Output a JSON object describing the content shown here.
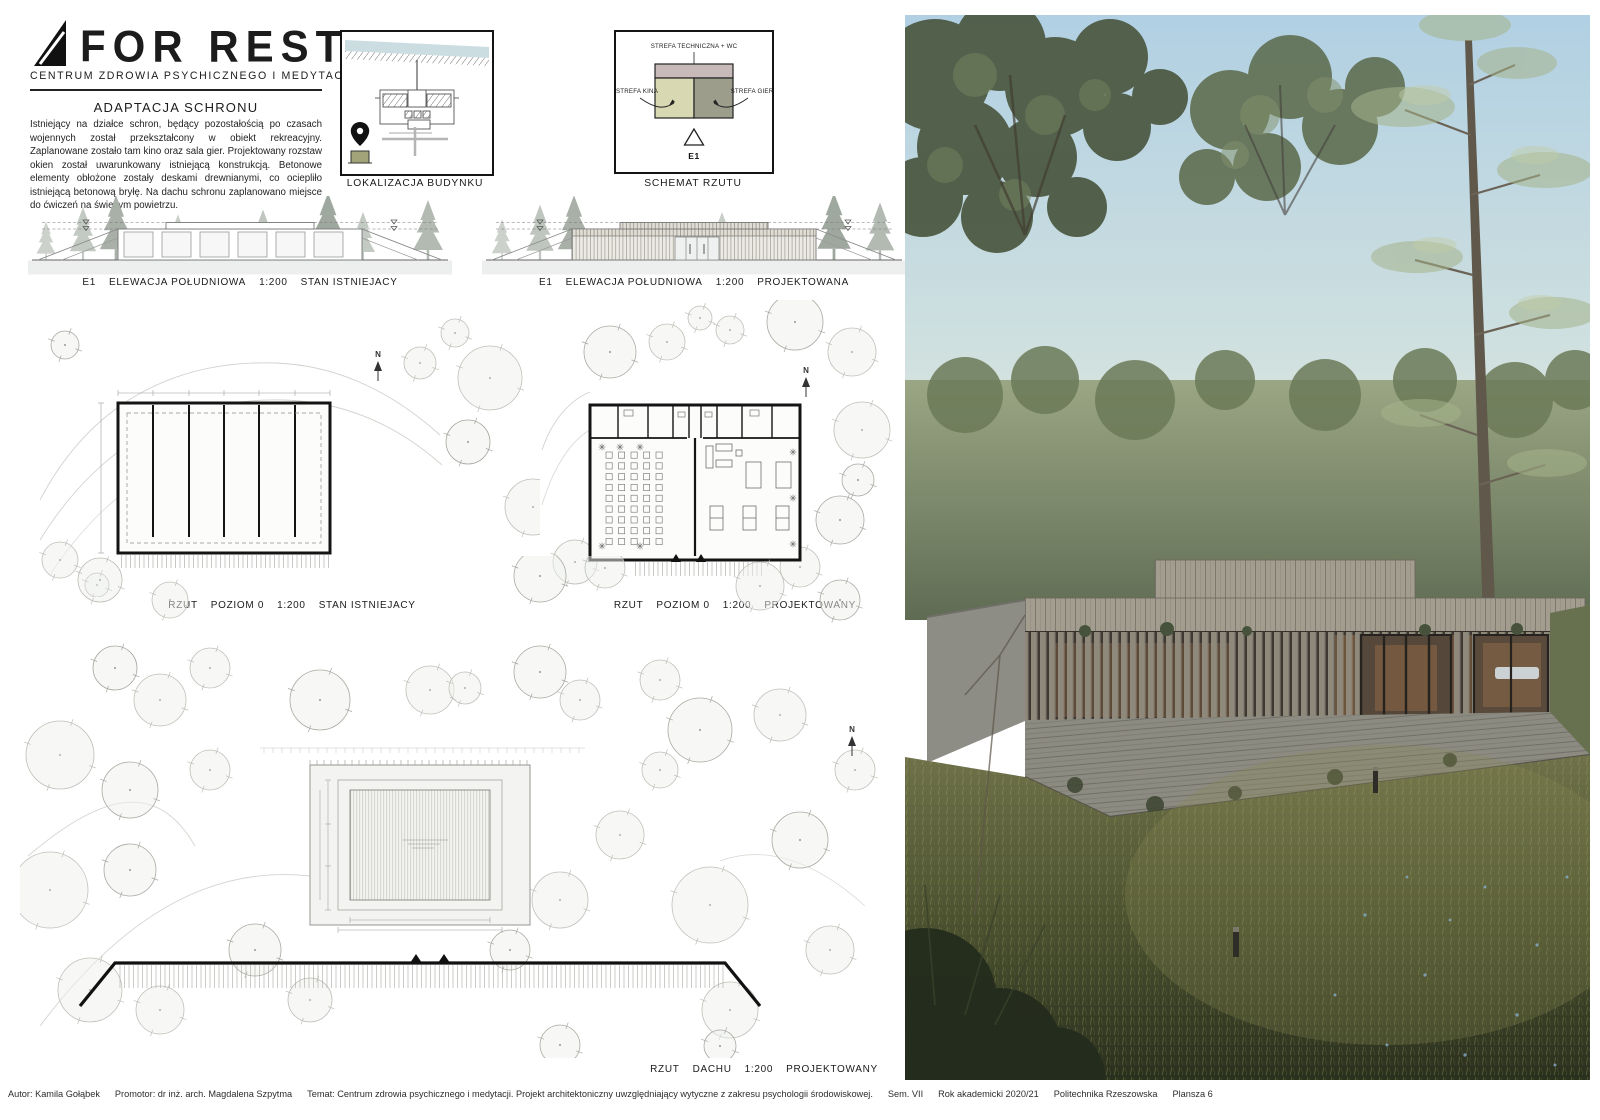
{
  "branding": {
    "logo_text": "FOR REST",
    "tagline": "CENTRUM ZDROWIA PSYCHICZNEGO I MEDYTACJI"
  },
  "intro": {
    "title": "ADAPTACJA SCHRONU",
    "body": "Istniejący na działce schron, będący pozostałością po czasach wojennych został przekształcony w obiekt rekreacyjny. Zaplanowane zostało tam kino oraz sala gier. Projektowany rozstaw okien został uwarunkowany istniejącą konstrukcją. Betonowe elementy obłożone zostały deskami drewnianymi, co ociepliło istniejącą betonową bryłę. Na dachu schronu zaplanowano miejsce do ćwiczeń na świeżym powietrzu."
  },
  "location_diagram": {
    "caption": "LOKALIZACJA BUDYNKU"
  },
  "schema_diagram": {
    "caption": "SCHEMAT RZUTU",
    "zone_technical": "STREFA TECHNICZNA + WC",
    "zone_cinema": "STREFA KINA",
    "zone_games": "STREFA GIER",
    "marker": "E1"
  },
  "captions": {
    "elevation_existing": {
      "code": "E1",
      "name": "ELEWACJA POŁUDNIOWA",
      "scale": "1:200",
      "status": "STAN ISTNIEJACY"
    },
    "elevation_proposed": {
      "code": "E1",
      "name": "ELEWACJA POŁUDNIOWA",
      "scale": "1:200",
      "status": "PROJEKTOWANA"
    },
    "plan_existing": {
      "name": "RZUT",
      "level": "POZIOM 0",
      "scale": "1:200",
      "status": "STAN ISTNIEJACY"
    },
    "plan_proposed": {
      "name": "RZUT",
      "level": "POZIOM 0",
      "scale": "1:200",
      "status": "PROJEKTOWANY"
    },
    "roof_plan": {
      "name": "RZUT",
      "level": "DACHU",
      "scale": "1:200",
      "status": "PROJEKTOWANY"
    }
  },
  "labels": {
    "north": "N"
  },
  "colors": {
    "zone_technical": "#c9baba",
    "zone_cinema": "#d8d8b2",
    "zone_games": "#9c9e8b",
    "site_marker": "#a3a379",
    "water": "#ccdde2"
  },
  "footer": {
    "author": "Autor: Kamila Gołąbek",
    "promotor": "Promotor: dr inż. arch. Magdalena Szpytma",
    "temat": "Temat: Centrum zdrowia psychicznego i medytacji. Projekt architektoniczny uwzględniający wytyczne z zakresu psychologii środowiskowej.",
    "sem": "Sem. VII",
    "rok": "Rok akademicki 2020/21",
    "uczelnia": "Politechnika Rzeszowska",
    "plansza": "Plansza 6"
  }
}
